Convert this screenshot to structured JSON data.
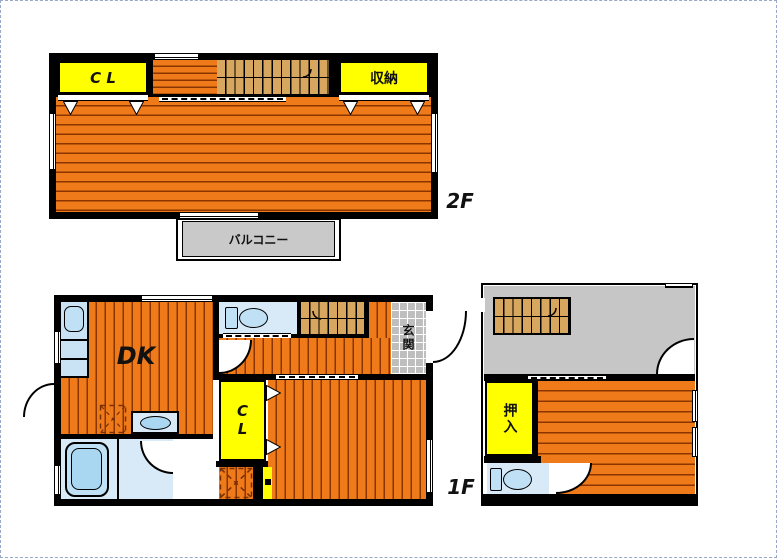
{
  "colors": {
    "wall": "#000000",
    "orange": "#EF7A1A",
    "line": "#8A3500",
    "yellow": "#FFFF00",
    "tan": "#D7A65F",
    "tile": "#BEBEBE",
    "balcony": "#C9C9C9",
    "annexgray": "#C6C6C6",
    "blueroom": "#D8EAF8",
    "bluefix": "#BFE0F5",
    "bluedeep": "#A9D6F0"
  },
  "floor2": {
    "floor_label": "2F",
    "closet": "C L",
    "storage": "収納",
    "balcony": "バルコニー"
  },
  "floor1": {
    "floor_label": "1F",
    "dining_kitchen": "DK",
    "closet": "CL",
    "entrance": "玄関"
  },
  "annex": {
    "oshiire": "押入"
  }
}
